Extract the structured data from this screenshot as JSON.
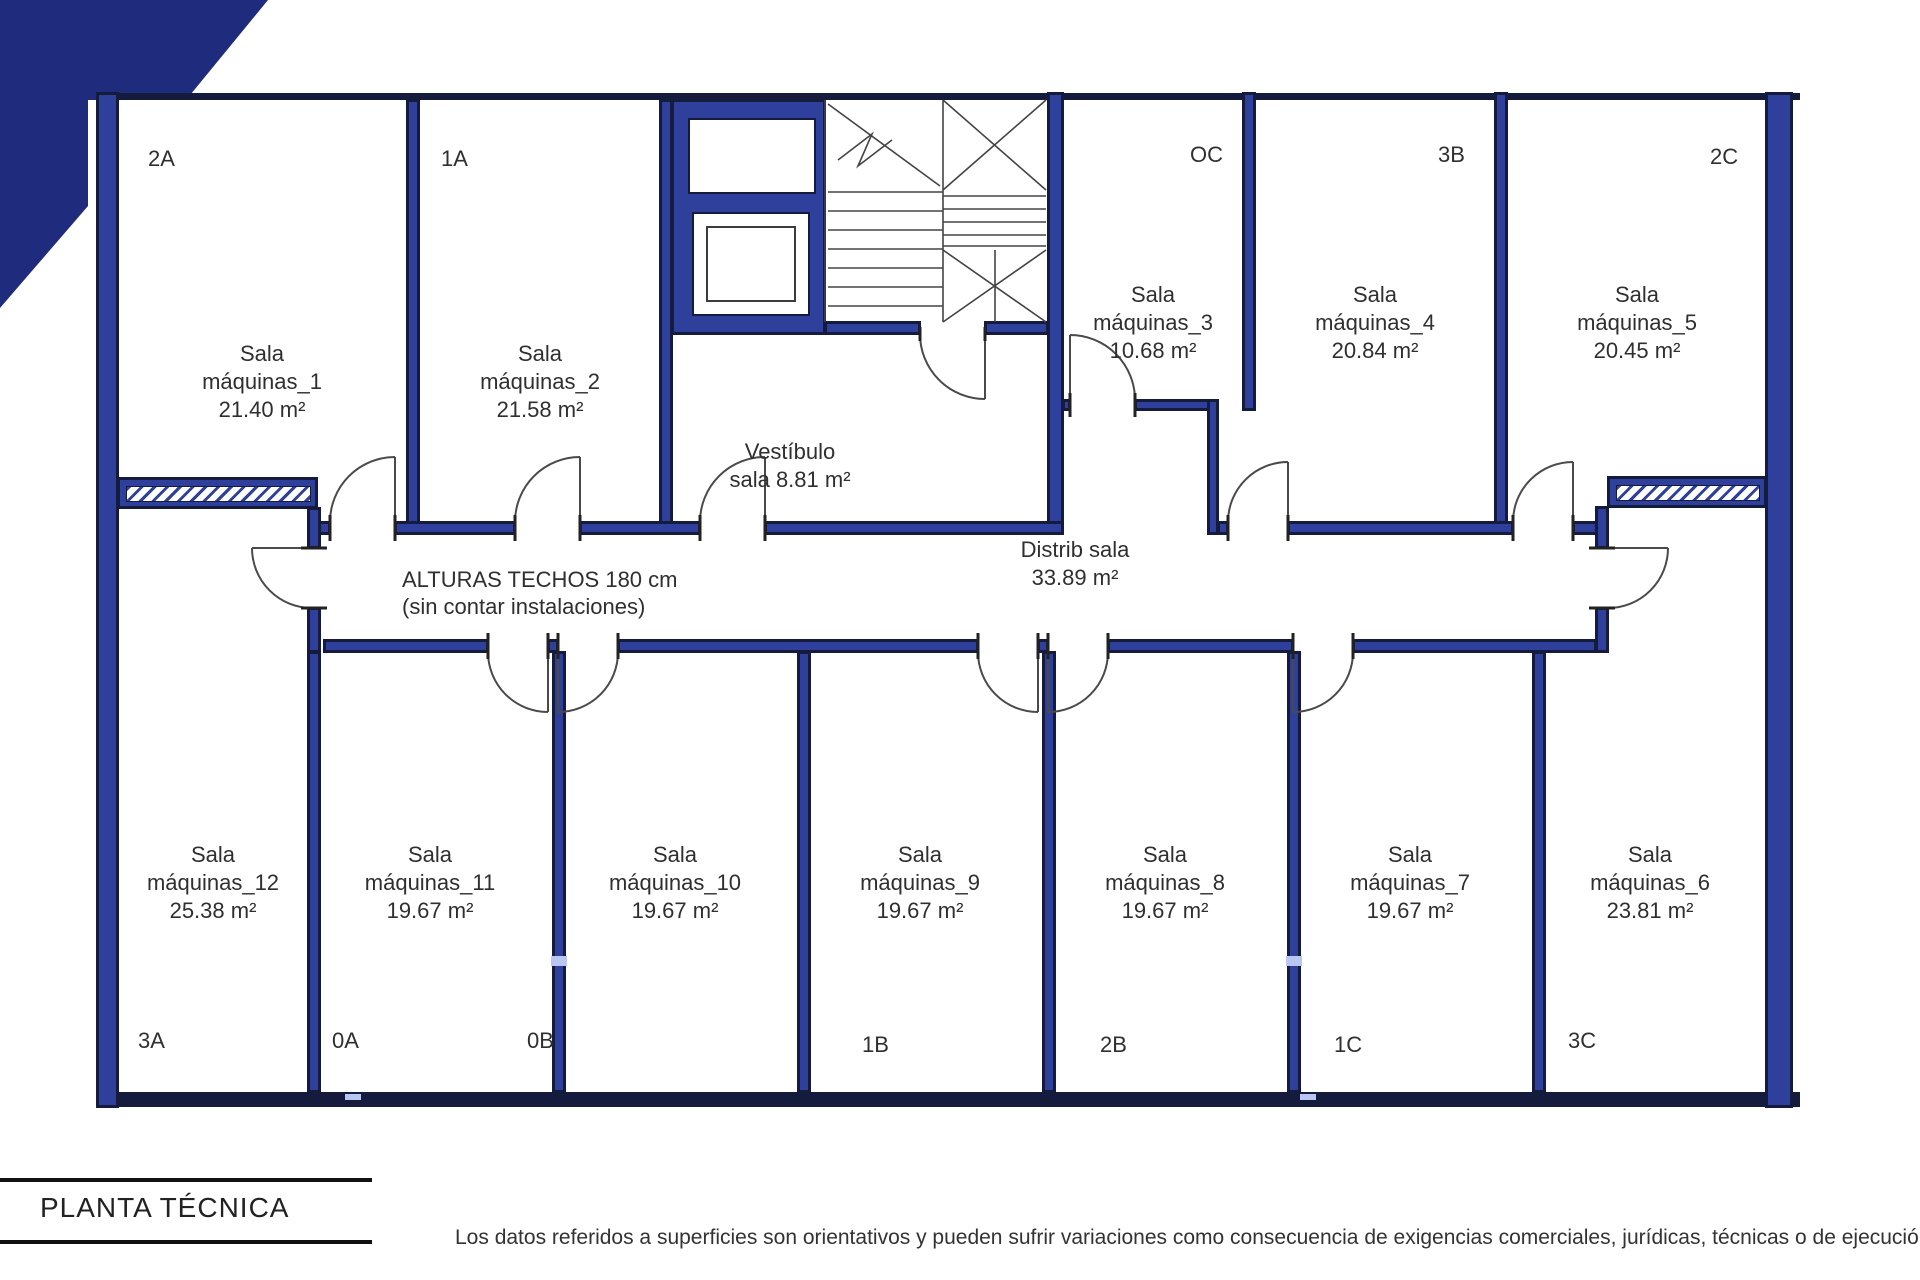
{
  "title_block": {
    "title": "PLANTA TÉCNICA"
  },
  "disclaimer": "Los datos referidos a superficies son orientativos y pueden sufrir variaciones como consecuencia de exigencias comerciales, jurídicas, técnicas o de ejecución de proyecto.",
  "notes": {
    "heights_line1": "ALTURAS TECHOS 180 cm",
    "heights_line2": "(sin contar instalaciones)"
  },
  "colors": {
    "wall_fill": "#2e3f9c",
    "wall_outline": "#141b3c",
    "corner_triangle": "#1f2b7c",
    "line": "#4a4a4a",
    "text": "#2f2f2f"
  },
  "halls": {
    "vestibulo": {
      "line1": "Vestíbulo",
      "line2": "sala 8.81 m²"
    },
    "distrib": {
      "line1": "Distrib sala",
      "line2": "33.89 m²"
    }
  },
  "rooms_upper": [
    {
      "unit": "2A",
      "l1": "Sala",
      "l2": "máquinas_1",
      "area": "21.40 m²"
    },
    {
      "unit": "1A",
      "l1": "Sala",
      "l2": "máquinas_2",
      "area": "21.58 m²"
    },
    {
      "unit": "OC",
      "l1": "Sala",
      "l2": "máquinas_3",
      "area": "10.68 m²"
    },
    {
      "unit": "3B",
      "l1": "Sala",
      "l2": "máquinas_4",
      "area": "20.84 m²"
    },
    {
      "unit": "2C",
      "l1": "Sala",
      "l2": "máquinas_5",
      "area": "20.45 m²"
    }
  ],
  "rooms_lower": [
    {
      "unit": "3A",
      "l1": "Sala",
      "l2": "máquinas_12",
      "area": "25.38 m²"
    },
    {
      "unit": "0A",
      "l1": "Sala",
      "l2": "máquinas_11",
      "area": "19.67 m²"
    },
    {
      "unit": "0B",
      "l1": "Sala",
      "l2": "máquinas_10",
      "area": "19.67 m²"
    },
    {
      "unit": "1B",
      "l1": "Sala",
      "l2": "máquinas_9",
      "area": "19.67 m²"
    },
    {
      "unit": "2B",
      "l1": "Sala",
      "l2": "máquinas_8",
      "area": "19.67 m²"
    },
    {
      "unit": "1C",
      "l1": "Sala",
      "l2": "máquinas_7",
      "area": "19.67 m²"
    },
    {
      "unit": "3C",
      "l1": "Sala",
      "l2": "máquinas_6",
      "area": "23.81 m²"
    }
  ]
}
